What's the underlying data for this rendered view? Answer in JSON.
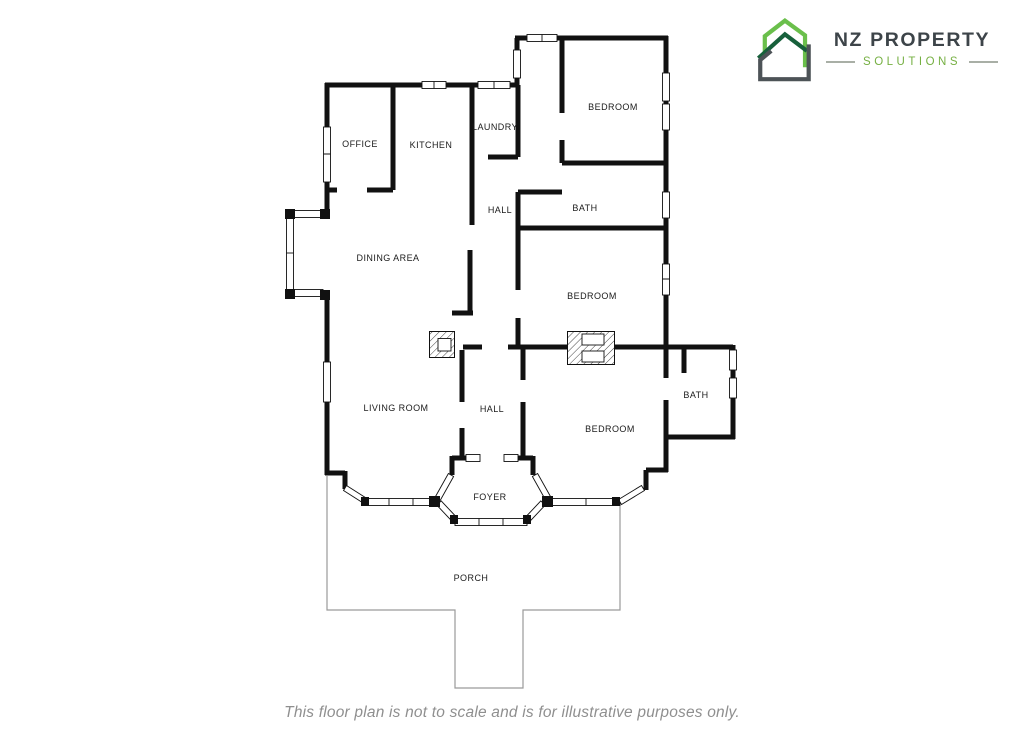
{
  "logo": {
    "title": "NZ PROPERTY",
    "subtitle": "SOLUTIONS",
    "icon": "house-outline-icon",
    "colors": {
      "light_green": "#6abf4b",
      "dark_green": "#17603b",
      "dark_gray": "#4d5357",
      "title_gray": "#3d4449",
      "subtitle_green": "#76b043",
      "dash_gray": "#a9afa6"
    }
  },
  "floor_plan": {
    "wall_color": "#111111",
    "porch_outline_color": "#9a9a9a",
    "label_color": "#1b1b1b",
    "rooms": [
      {
        "label": "OFFICE"
      },
      {
        "label": "KITCHEN"
      },
      {
        "label": "LAUNDRY"
      },
      {
        "label": "BEDROOM"
      },
      {
        "label": "HALL"
      },
      {
        "label": "BATH"
      },
      {
        "label": "DINING AREA"
      },
      {
        "label": "BEDROOM"
      },
      {
        "label": "LIVING ROOM"
      },
      {
        "label": "HALL"
      },
      {
        "label": "BEDROOM"
      },
      {
        "label": "BATH"
      },
      {
        "label": "FOYER"
      },
      {
        "label": "PORCH"
      }
    ],
    "symbols": [
      "window",
      "bay-window",
      "fireplace-chimney",
      "porch-outline"
    ]
  },
  "footer": {
    "disclaimer": "This floor plan is not to scale and is for illustrative purposes only."
  }
}
